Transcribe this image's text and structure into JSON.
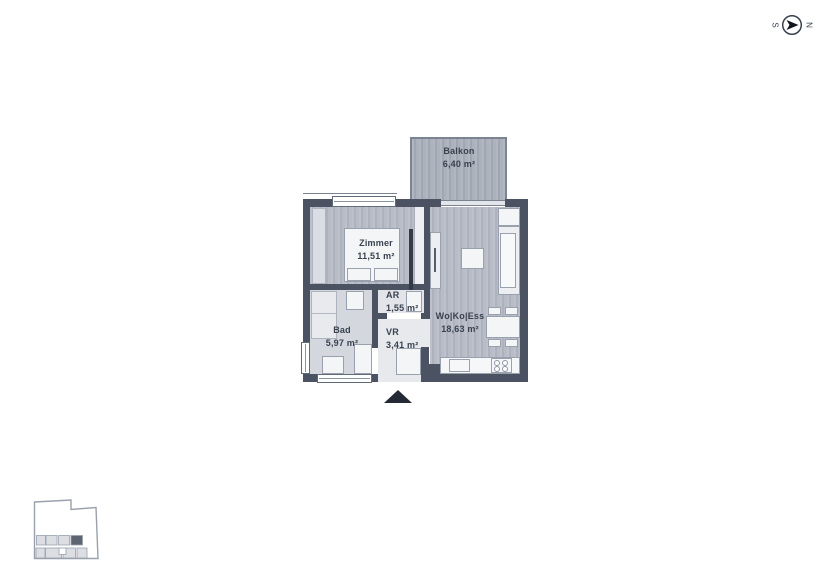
{
  "compass": {
    "south": "S",
    "north": "N"
  },
  "plan": {
    "rooms": {
      "balkon": {
        "name": "Balkon",
        "area": "6,40 m²"
      },
      "zimmer": {
        "name": "Zimmer",
        "area": "11,51 m²"
      },
      "ar": {
        "name": "AR",
        "area": "1,55 m²"
      },
      "bad": {
        "name": "Bad",
        "area": "5,97 m²"
      },
      "vr": {
        "name": "VR",
        "area": "3,41 m²"
      },
      "wokoess": {
        "name": "Wo|Ko|Ess",
        "area": "18,63 m²"
      }
    }
  },
  "colors": {
    "wall": "#4b5362",
    "living_floor": "#b6bbc6",
    "balcony_floor": "#a9b0bb",
    "bath_floor": "#d4d7de",
    "hall_floor": "#e7e9ed",
    "furniture": "#f4f5f7",
    "outline": "#9aa1ae",
    "text": "#39414f",
    "entrance_arrow": "#242a35",
    "keyplan_highlight": "#5d6573"
  }
}
